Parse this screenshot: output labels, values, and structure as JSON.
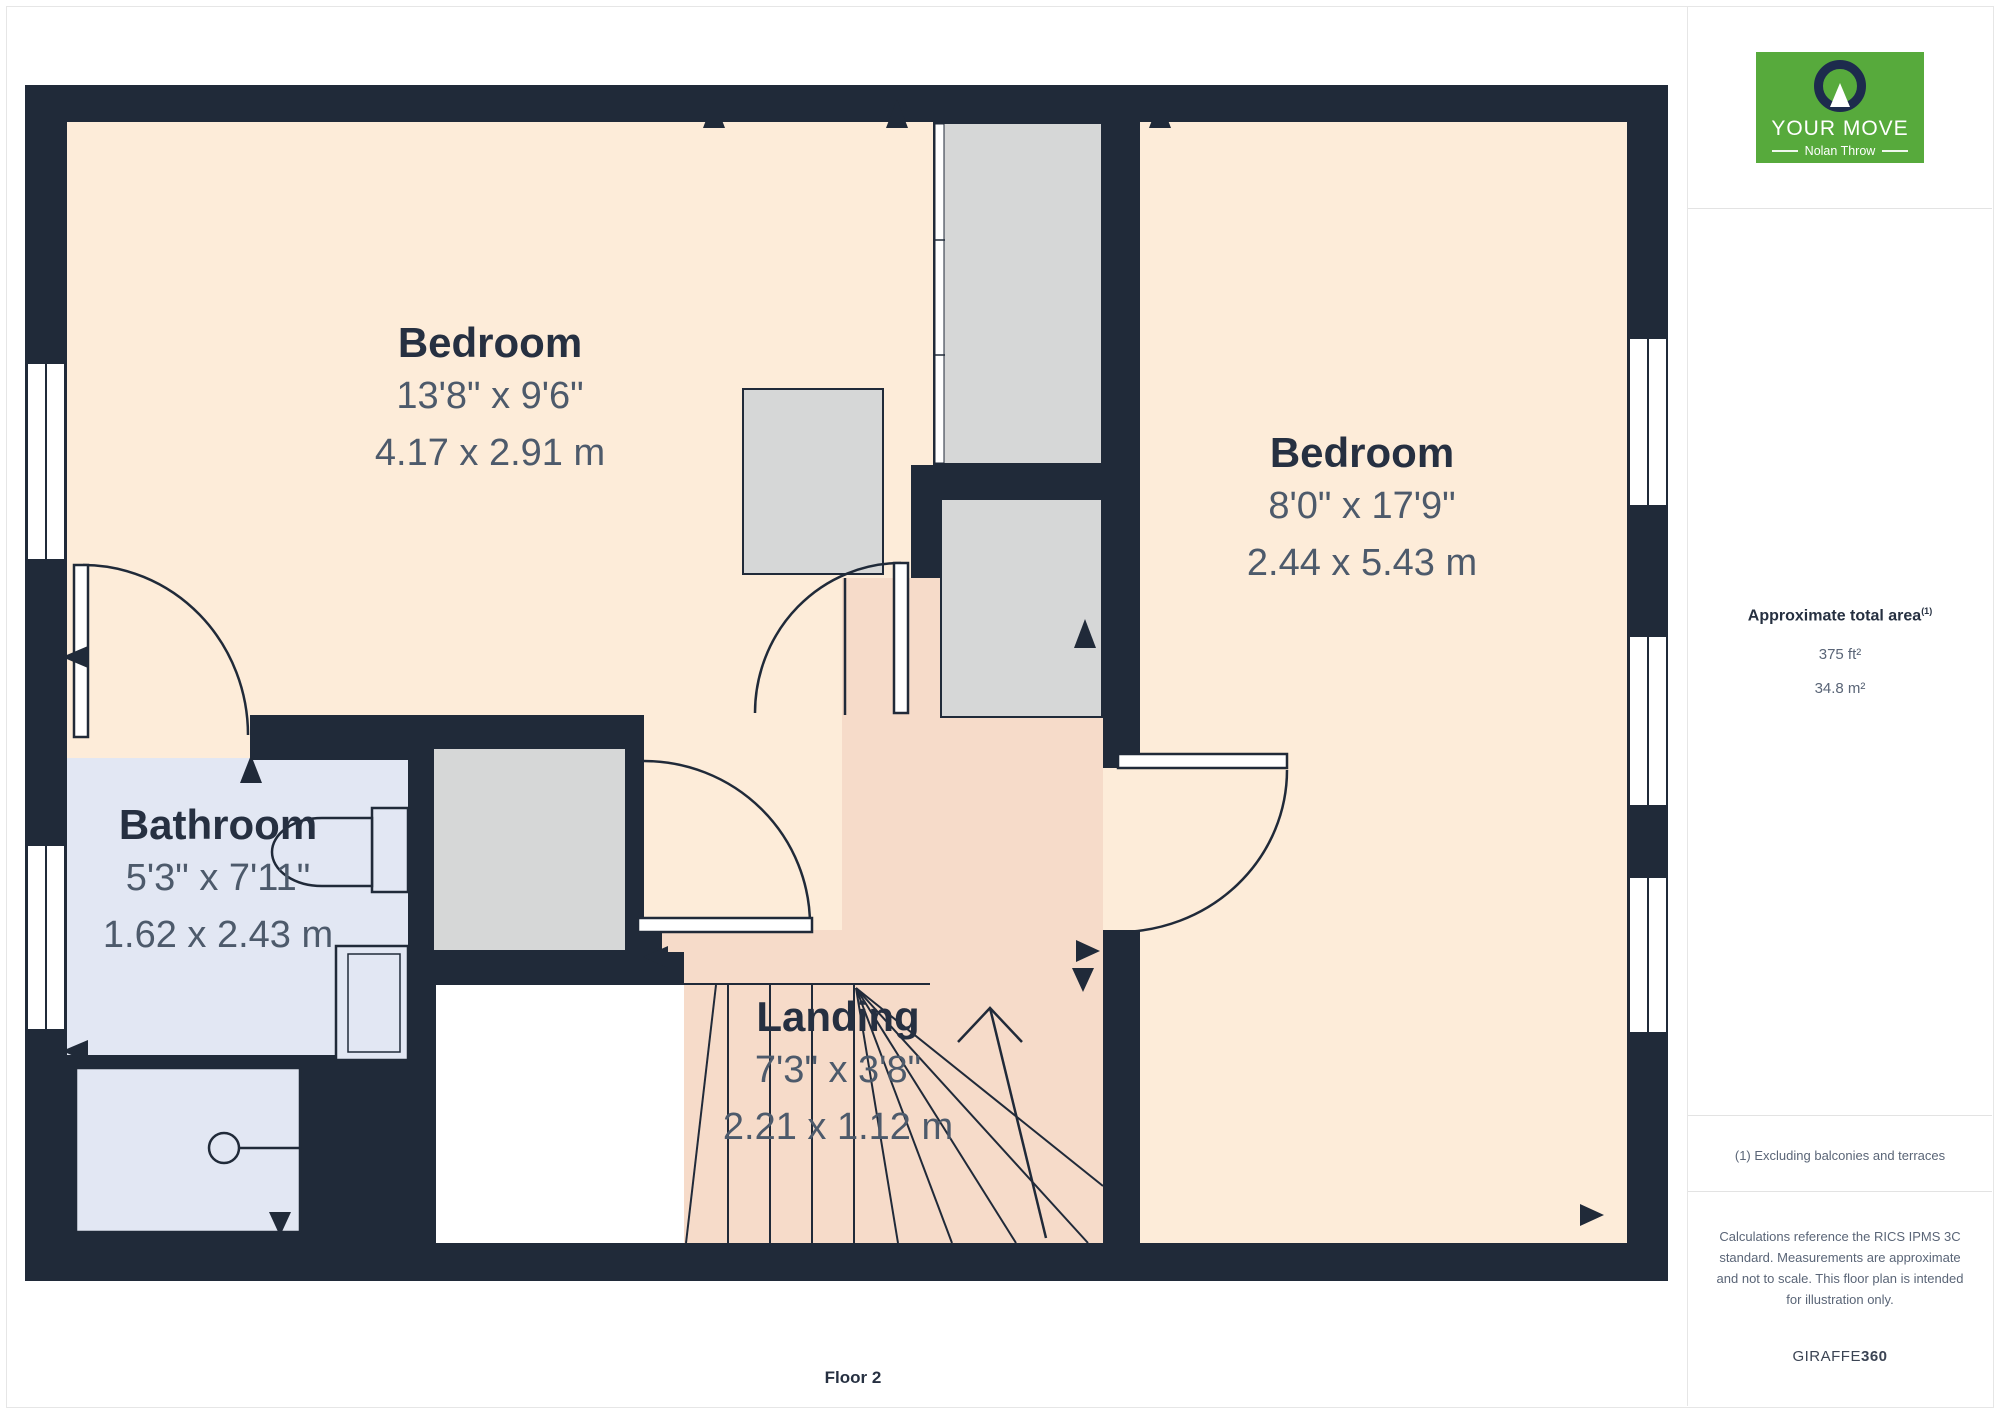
{
  "page": {
    "floor_label": "Floor 2"
  },
  "watermark": {
    "title": "YOUR MOVE",
    "subtitle": "Nolan Throw"
  },
  "logo": {
    "brand": "YOUR MOVE",
    "subbrand": "Nolan Throw"
  },
  "rooms": [
    {
      "id": "bedroom-1",
      "name": "Bedroom",
      "dims_imperial": "13'8\" x 9'6\"",
      "dims_metric": "4.17 x 2.91 m"
    },
    {
      "id": "bedroom-2",
      "name": "Bedroom",
      "dims_imperial": "8'0\" x 17'9\"",
      "dims_metric": "2.44 x 5.43 m"
    },
    {
      "id": "bathroom",
      "name": "Bathroom",
      "dims_imperial": "5'3\" x 7'11\"",
      "dims_metric": "1.62 x 2.43 m"
    },
    {
      "id": "landing",
      "name": "Landing",
      "dims_imperial": "7'3\" x 3'8\"",
      "dims_metric": "2.21 x 1.12 m"
    }
  ],
  "sidebar": {
    "area_title": "Approximate total area",
    "area_note_sup": "(1)",
    "area_ft": "375 ft²",
    "area_m": "34.8 m²",
    "footnote": "(1) Excluding balconies and terraces",
    "disclaimer": "Calculations reference the RICS IPMS 3C standard. Measurements are approximate and not to scale. This floor plan is intended for illustration only.",
    "brand_name": "GIRAFFE",
    "brand_number": "360"
  },
  "colors": {
    "wall": "#202a39",
    "bedroom_floor": "#fdecd9",
    "landing_floor": "#f6dbc9",
    "bathroom_floor": "#e2e7f3",
    "closet_fill": "#d6d7d7",
    "brand_green": "#57aa3c",
    "dim_text": "#4d5a6b",
    "label_text": "#263041"
  }
}
